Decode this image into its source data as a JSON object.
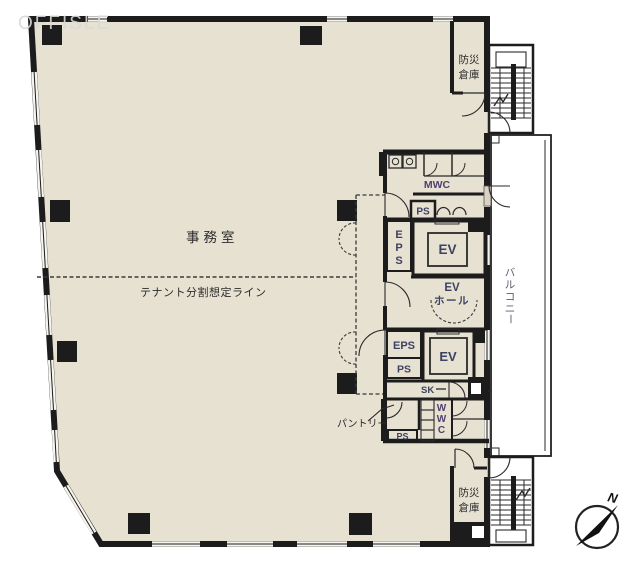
{
  "watermark": "OFFISLE",
  "plan": {
    "office_label": "事務室",
    "tenant_split_label": "テナント分割想定ライン",
    "core": {
      "mwc_label": "MWC",
      "ps_upper_label": "PS",
      "eps_shaft_chars": [
        "E",
        "P",
        "S"
      ],
      "elevator1_label": "EV",
      "ev_hall_line1": "EV",
      "ev_hall_line2": "ホール",
      "eps2_label": "EPS",
      "ps2_label": "PS",
      "elevator2_label": "EV",
      "sk_label": "SK",
      "ps_riser_label": "PS",
      "pantry_label": "パントリー",
      "pantry_ps_label": "PS",
      "wwc_chars": [
        "W",
        "W",
        "C"
      ]
    },
    "balcony_chars": [
      "バ",
      "ル",
      "コ",
      "ニ",
      "ー"
    ],
    "storage_top": {
      "line1": "防災",
      "line2": "倉庫"
    },
    "storage_bottom": {
      "line1": "防災",
      "line2": "倉庫"
    },
    "compass_north": "N"
  },
  "colors": {
    "floor": "#e7e1d2",
    "wall": "#1c1c1c",
    "room_code_text": "#3d4263",
    "wc_text": "#4e4270"
  }
}
